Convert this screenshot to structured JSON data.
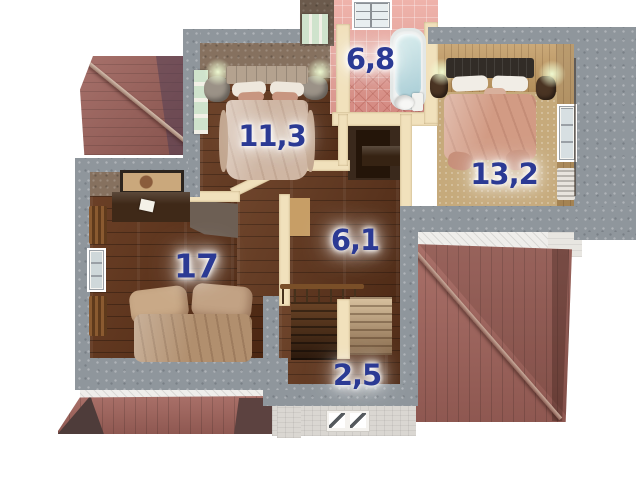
{
  "plan": {
    "view": "3d-floor-plan-render",
    "background": "#ffffff"
  },
  "rooms": [
    {
      "name": "bedroom-top",
      "area": "11,3"
    },
    {
      "name": "bathroom",
      "area": "6,8"
    },
    {
      "name": "bedroom-right",
      "area": "13,2"
    },
    {
      "name": "bedroom-left",
      "area": "17"
    },
    {
      "name": "hallway",
      "area": "6,1"
    },
    {
      "name": "stair-landing",
      "area": "2,5"
    }
  ],
  "colors": {
    "area_label": "#2b3a94",
    "roof_red": "#a2645c",
    "roof_shadow": "#5c4340",
    "wall_concrete": "#8f969c",
    "wall_partition_cream": "#f1e1bc",
    "floor_wood": "#5e331a",
    "floor_carpet": "#c6aa7b",
    "bathroom_tile_pink": "#e5a79f"
  }
}
